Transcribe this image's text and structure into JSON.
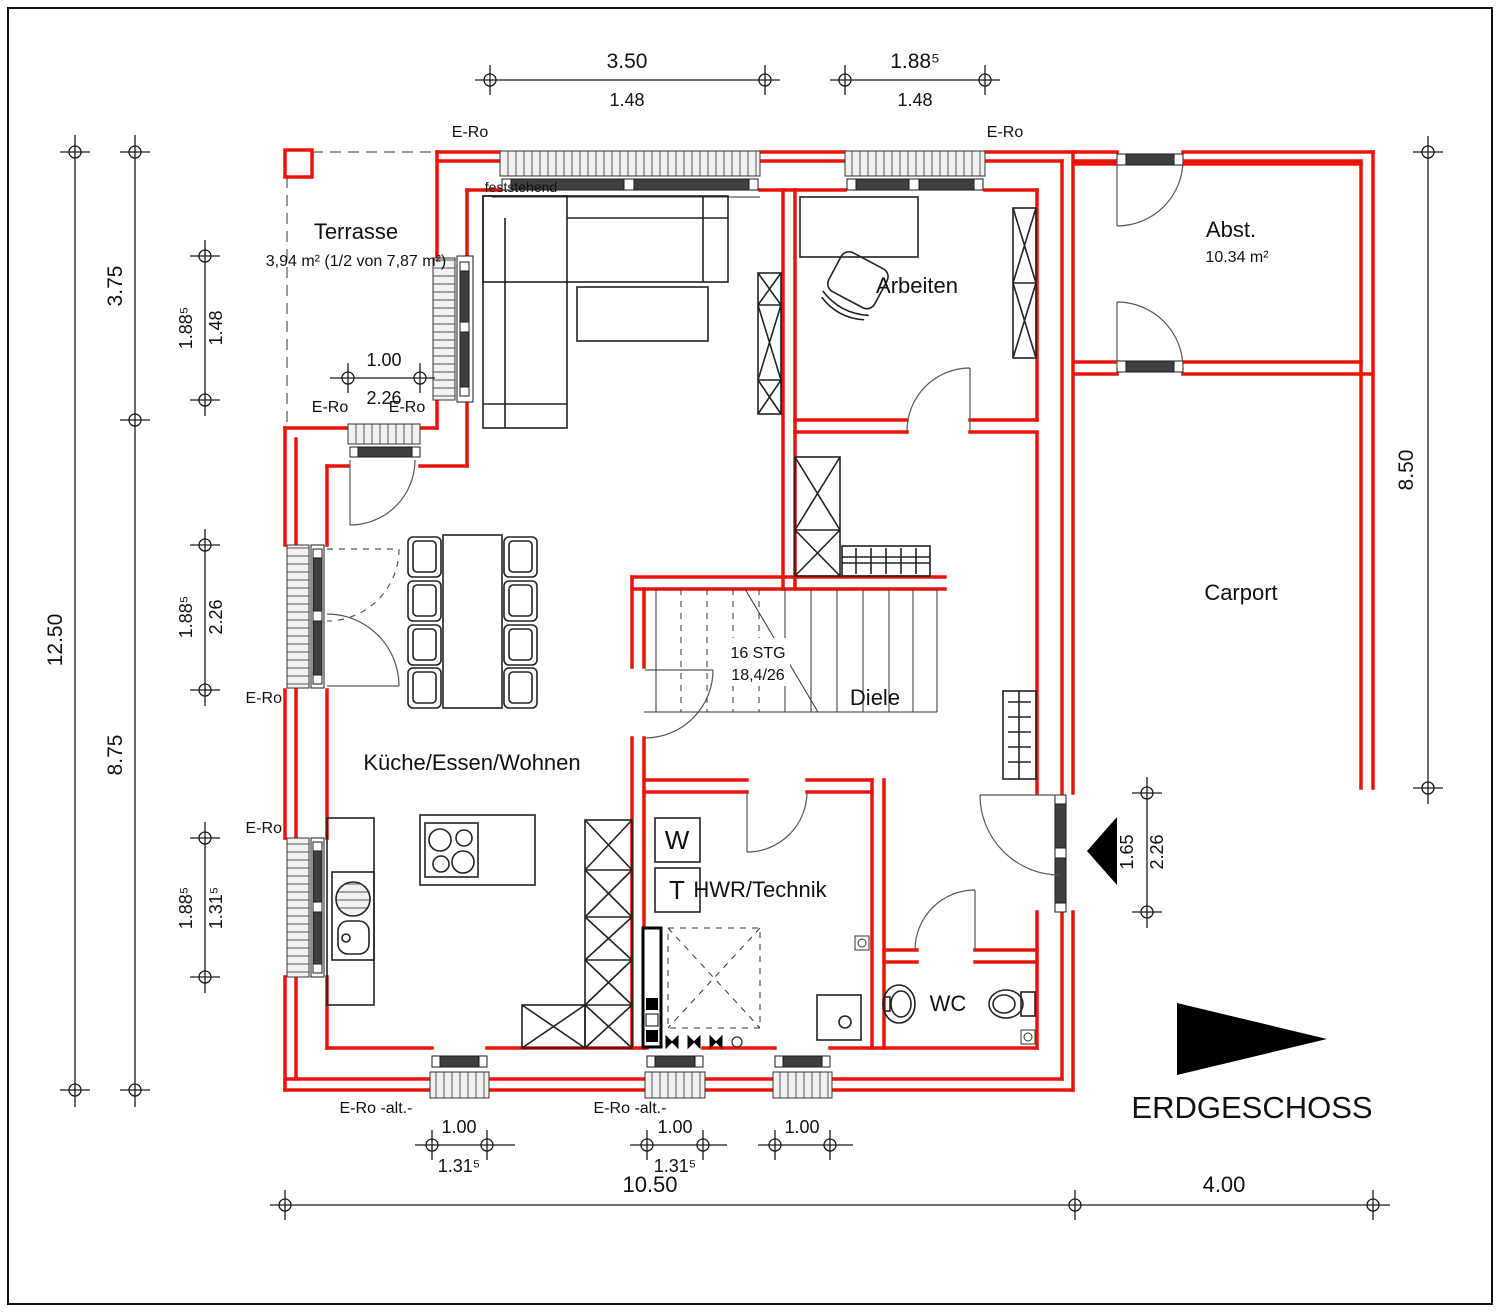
{
  "title": {
    "label": "ERDGESCHOSS"
  },
  "colors": {
    "wall_red": "#ec1309",
    "line_black": "#1a1a1a",
    "glazing": "#3f3f3f"
  },
  "rooms": {
    "terrasse": {
      "name": "Terrasse",
      "area": "3,94 m² (1/2 von 7,87 m²)"
    },
    "arbeiten": {
      "name": "Arbeiten"
    },
    "abst": {
      "name": "Abst.",
      "area": "10.34 m²"
    },
    "carport": {
      "name": "Carport"
    },
    "diele": {
      "name": "Diele"
    },
    "kueche": {
      "name": "Küche/Essen/Wohnen"
    },
    "hwr": {
      "name": "HWR/Technik"
    },
    "wc": {
      "name": "WC"
    }
  },
  "appliances": {
    "washer": "W",
    "dryer": "T"
  },
  "stairs": {
    "steps": "16 STG",
    "ratio": "18,4/26"
  },
  "windows": {
    "fixed_note": "feststehend",
    "roller": "E-Ro",
    "roller_alt": "E-Ro -alt.-"
  },
  "dims": {
    "top_a": "3.50",
    "top_a_inner": "1.48",
    "top_b": "1.88⁵",
    "top_b_inner": "1.48",
    "left_total": "12.50",
    "left_upper": "3.75",
    "left_lower": "8.75",
    "lw1_a": "1.88⁵",
    "lw1_b": "1.48",
    "lw2_a": "1.88⁵",
    "lw2_b": "2.26",
    "lw3_a": "1.88⁵",
    "lw3_b": "1.31⁵",
    "terrace_a": "1.00",
    "terrace_b": "2.26",
    "right_carport": "8.50",
    "ent_a": "1.65",
    "ent_b": "2.26",
    "bw1_a": "1.00",
    "bw1_b": "1.31⁵",
    "bw2_a": "1.00",
    "bw2_b": "1.31⁵",
    "bw3_a": "1.00",
    "bottom_house": "10.50",
    "bottom_carport": "4.00"
  }
}
